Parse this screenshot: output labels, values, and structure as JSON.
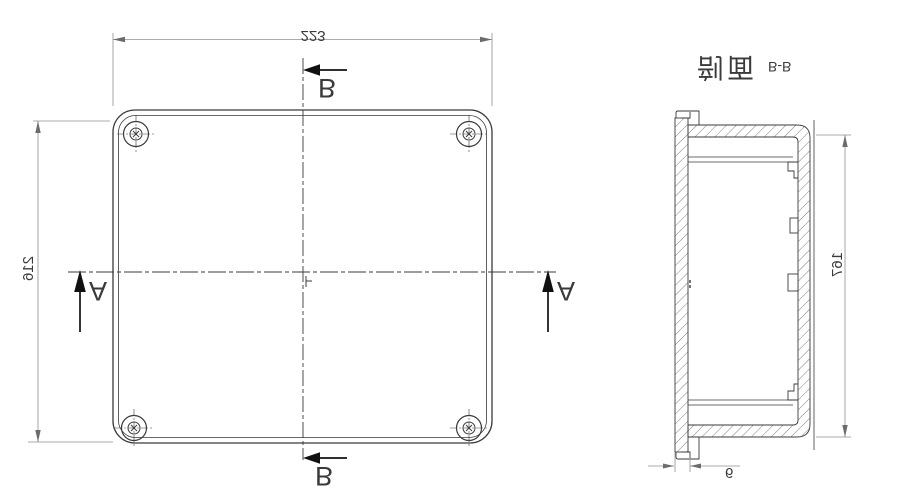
{
  "drawing": {
    "section_title": {
      "name": "剖面",
      "ref": "B-B"
    },
    "markers": {
      "a": "A",
      "b": "B"
    },
    "dims": {
      "width": "223",
      "height": "216",
      "depth": "167",
      "wall": "6"
    },
    "colors": {
      "part_line": "#3a3a3a",
      "dimension_line": "#8f8f8f",
      "background": "#ffffff"
    }
  }
}
